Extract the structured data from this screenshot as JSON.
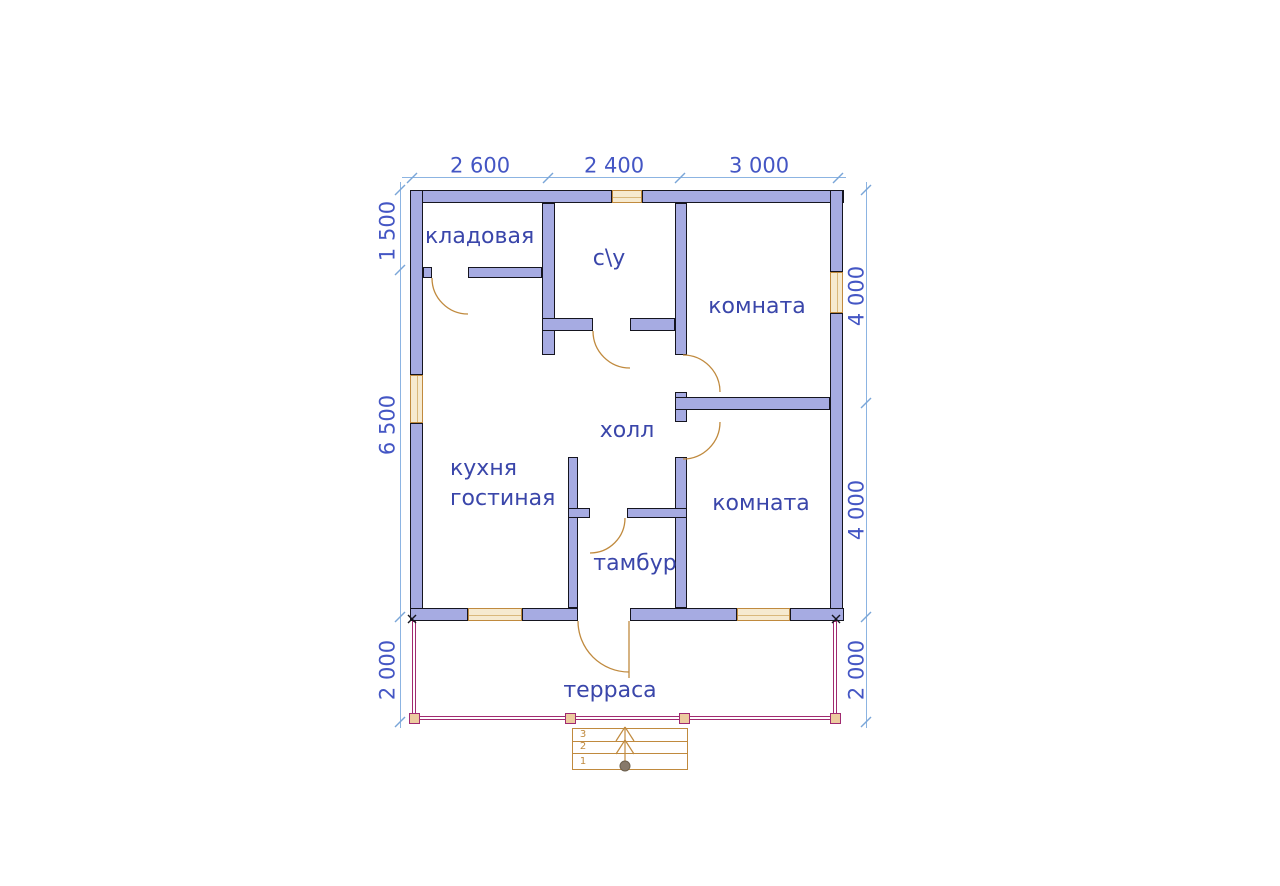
{
  "type": "floor_plan",
  "colors": {
    "wall_fill": "#a6abe2",
    "wall_outline": "#15151f",
    "dim_line": "#8cb4e2",
    "dim_text": "#4456c4",
    "room_text": "#3a46aa",
    "joinery": "#c08a3e",
    "window_fill": "#f6ead0",
    "terrace_line": "#a02a70",
    "post_fill": "#eccb9f",
    "stair_knob": "#87796a"
  },
  "rooms": [
    {
      "name": "storage",
      "label": "кладовая",
      "x": 425,
      "y": 237,
      "align": "left"
    },
    {
      "name": "bathroom",
      "label": "с\\у",
      "x": 609,
      "y": 259,
      "align": "center"
    },
    {
      "name": "room-top",
      "label": "комната",
      "x": 757,
      "y": 307,
      "align": "center"
    },
    {
      "name": "hall",
      "label": "холл",
      "x": 627,
      "y": 431,
      "align": "center"
    },
    {
      "name": "kitchen",
      "label": "кухня",
      "x": 450,
      "y": 469,
      "align": "left"
    },
    {
      "name": "living",
      "label": "гостиная",
      "x": 450,
      "y": 499,
      "align": "left"
    },
    {
      "name": "room-bottom",
      "label": "комната",
      "x": 761,
      "y": 504,
      "align": "center"
    },
    {
      "name": "vestibule",
      "label": "тамбур",
      "x": 635,
      "y": 564,
      "align": "center"
    },
    {
      "name": "terrace",
      "label": "терраса",
      "x": 610,
      "y": 691,
      "align": "center"
    }
  ],
  "dimensions": {
    "top": {
      "line": {
        "x1": 402,
        "x2": 846,
        "y": 177
      },
      "ticks": [
        412,
        548,
        680,
        838
      ],
      "label_y": 166,
      "labels": [
        {
          "text": "2 600",
          "cx": 480
        },
        {
          "text": "2 400",
          "cx": 614
        },
        {
          "text": "3 000",
          "cx": 759
        }
      ]
    },
    "left": {
      "line": {
        "x": 400,
        "y1": 182,
        "y2": 728
      },
      "ticks": [
        190,
        270,
        617,
        722
      ],
      "label_x": 388,
      "labels": [
        {
          "text": "1 500",
          "cy": 231
        },
        {
          "text": "6 500",
          "cy": 425
        },
        {
          "text": "2 000",
          "cy": 670
        }
      ]
    },
    "right": {
      "line": {
        "x": 866,
        "y1": 182,
        "y2": 728
      },
      "ticks": [
        190,
        403,
        617,
        722
      ],
      "label_x": 857,
      "labels": [
        {
          "text": "4 000",
          "cy": 296
        },
        {
          "text": "4 000",
          "cy": 510
        },
        {
          "text": "2 000",
          "cy": 670
        }
      ]
    }
  },
  "walls": [
    {
      "n": "wall-top-left",
      "r": [
        410,
        190,
        202,
        13
      ]
    },
    {
      "n": "wall-top-right",
      "r": [
        642,
        190,
        202,
        13
      ]
    },
    {
      "n": "wall-left-upper",
      "r": [
        410,
        190,
        13,
        185
      ]
    },
    {
      "n": "wall-left-lower",
      "r": [
        410,
        423,
        13,
        198
      ]
    },
    {
      "n": "wall-right-upper",
      "r": [
        830,
        190,
        13,
        82
      ]
    },
    {
      "n": "wall-right-lower",
      "r": [
        830,
        313,
        13,
        308
      ]
    },
    {
      "n": "wall-bottom-1",
      "r": [
        410,
        608,
        58,
        13
      ]
    },
    {
      "n": "wall-bottom-2",
      "r": [
        522,
        608,
        56,
        13
      ]
    },
    {
      "n": "wall-bottom-3",
      "r": [
        630,
        608,
        107,
        13
      ]
    },
    {
      "n": "wall-bottom-4",
      "r": [
        790,
        608,
        54,
        13
      ]
    },
    {
      "n": "wall-bathroom-left",
      "r": [
        542,
        203,
        13,
        152
      ]
    },
    {
      "n": "wall-storage-stub",
      "r": [
        423,
        267,
        9,
        11
      ]
    },
    {
      "n": "wall-storage-bottom",
      "r": [
        468,
        267,
        74,
        11
      ]
    },
    {
      "n": "wall-bathroom-bottom-left",
      "r": [
        542,
        318,
        51,
        13
      ]
    },
    {
      "n": "wall-bathroom-bottom-right",
      "r": [
        630,
        318,
        45,
        13
      ]
    },
    {
      "n": "wall-center-upper",
      "r": [
        675,
        203,
        12,
        152
      ]
    },
    {
      "n": "wall-center-mid",
      "r": [
        675,
        392,
        12,
        30
      ]
    },
    {
      "n": "wall-center-lower",
      "r": [
        675,
        457,
        12,
        151
      ]
    },
    {
      "n": "wall-rooms-divider",
      "r": [
        675,
        397,
        155,
        13
      ]
    },
    {
      "n": "wall-vestibule-left",
      "r": [
        568,
        457,
        10,
        151
      ]
    },
    {
      "n": "wall-hall-stub",
      "r": [
        568,
        508,
        22,
        10
      ]
    },
    {
      "n": "wall-hall-divider",
      "r": [
        627,
        508,
        60,
        10
      ]
    }
  ],
  "windows": [
    {
      "n": "window-bathroom-top",
      "r": [
        612,
        190,
        30,
        13
      ],
      "o": "h"
    },
    {
      "n": "window-kitchen-left",
      "r": [
        410,
        375,
        13,
        48
      ],
      "o": "v"
    },
    {
      "n": "window-room-top-right",
      "r": [
        830,
        272,
        13,
        41
      ],
      "o": "v"
    },
    {
      "n": "window-kitchen-bottom",
      "r": [
        468,
        608,
        54,
        13
      ],
      "o": "h"
    },
    {
      "n": "window-room-bottom",
      "r": [
        737,
        608,
        53,
        13
      ],
      "o": "h"
    }
  ],
  "doors": [
    {
      "name": "door-arc-storage",
      "d": "M432,278 A36,36 0 0 0 468,314"
    },
    {
      "name": "door-arc-bathroom",
      "d": "M593,331 A37,37 0 0 0 630,368"
    },
    {
      "name": "door-arc-room-top",
      "d": "M683,355 A37,37 0 0 1 720,392"
    },
    {
      "name": "door-arc-room-bottom",
      "d": "M720,422 A37,37 0 0 1 683,459"
    },
    {
      "name": "door-arc-vestibule",
      "d": "M625,518 A35,35 0 0 1 590,553"
    },
    {
      "name": "door-arc-entrance",
      "d": "M578,621 A51,51 0 0 0 629,672"
    },
    {
      "name": "door-leaf-entrance",
      "line": [
        629,
        621,
        629,
        678
      ]
    }
  ],
  "terrace": {
    "rails": [
      {
        "n": "terrace-rail-left",
        "r": [
          412,
          621,
          4,
          98
        ]
      },
      {
        "n": "terrace-rail-bottom",
        "r": [
          412,
          716,
          425,
          4
        ]
      },
      {
        "n": "terrace-rail-right",
        "r": [
          833,
          621,
          4,
          98
        ]
      }
    ],
    "posts": [
      {
        "cx": 414,
        "cy": 718
      },
      {
        "cx": 570,
        "cy": 718
      },
      {
        "cx": 684,
        "cy": 718
      },
      {
        "cx": 835,
        "cy": 718
      }
    ],
    "corner_marks": [
      {
        "x": 412,
        "y": 619
      },
      {
        "x": 836,
        "y": 619
      }
    ]
  },
  "stairs": {
    "box": {
      "x": 572,
      "y": 728,
      "w": 116,
      "h": 42
    },
    "dividers": [
      741,
      753
    ],
    "steps": [
      {
        "label": "3",
        "x": 583,
        "y": 735
      },
      {
        "label": "2",
        "x": 583,
        "y": 747
      },
      {
        "label": "1",
        "x": 583,
        "y": 762
      }
    ],
    "arrow": {
      "x": 625,
      "from_y": 765,
      "to_y": 727
    },
    "knob": {
      "cx": 625,
      "cy": 766,
      "r": 5
    }
  }
}
